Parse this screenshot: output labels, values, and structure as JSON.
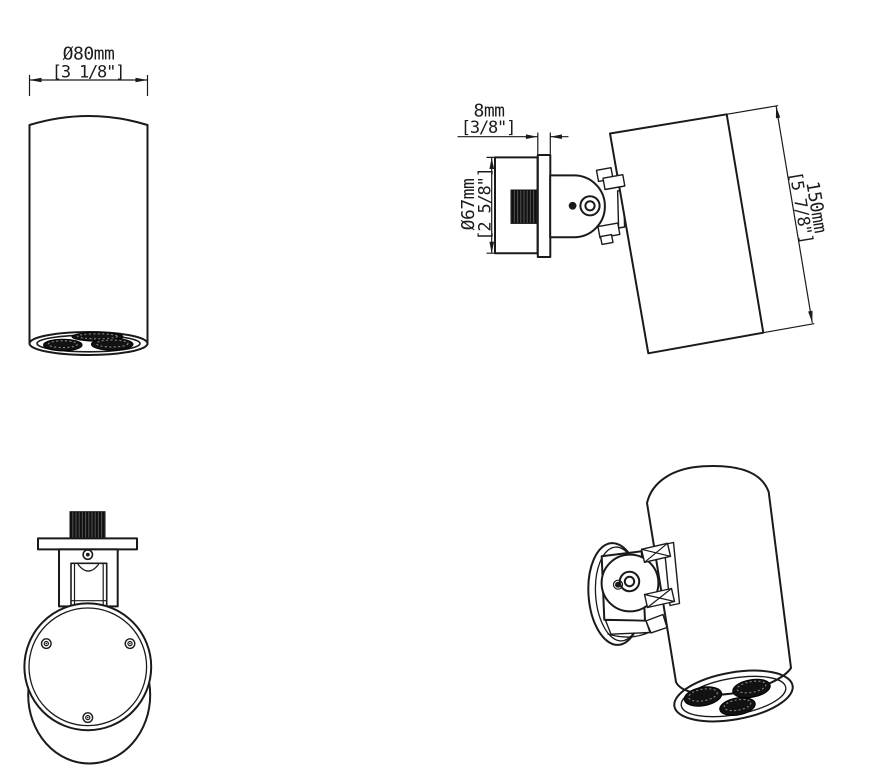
{
  "colors": {
    "background": "#ffffff",
    "line": "#1a1a1a"
  },
  "views": {
    "front": {
      "dim_diameter": {
        "metric": "Ø80mm",
        "imperial": "[3 1/8\"]"
      }
    },
    "side": {
      "dim_plate": {
        "metric": "8mm",
        "imperial": "[3/8\"]"
      },
      "dim_base": {
        "metric": "Ø67mm",
        "imperial": "[2 5/8\"]"
      },
      "dim_length": {
        "metric": "150mm",
        "imperial": "[5 7/8\"]"
      }
    }
  }
}
